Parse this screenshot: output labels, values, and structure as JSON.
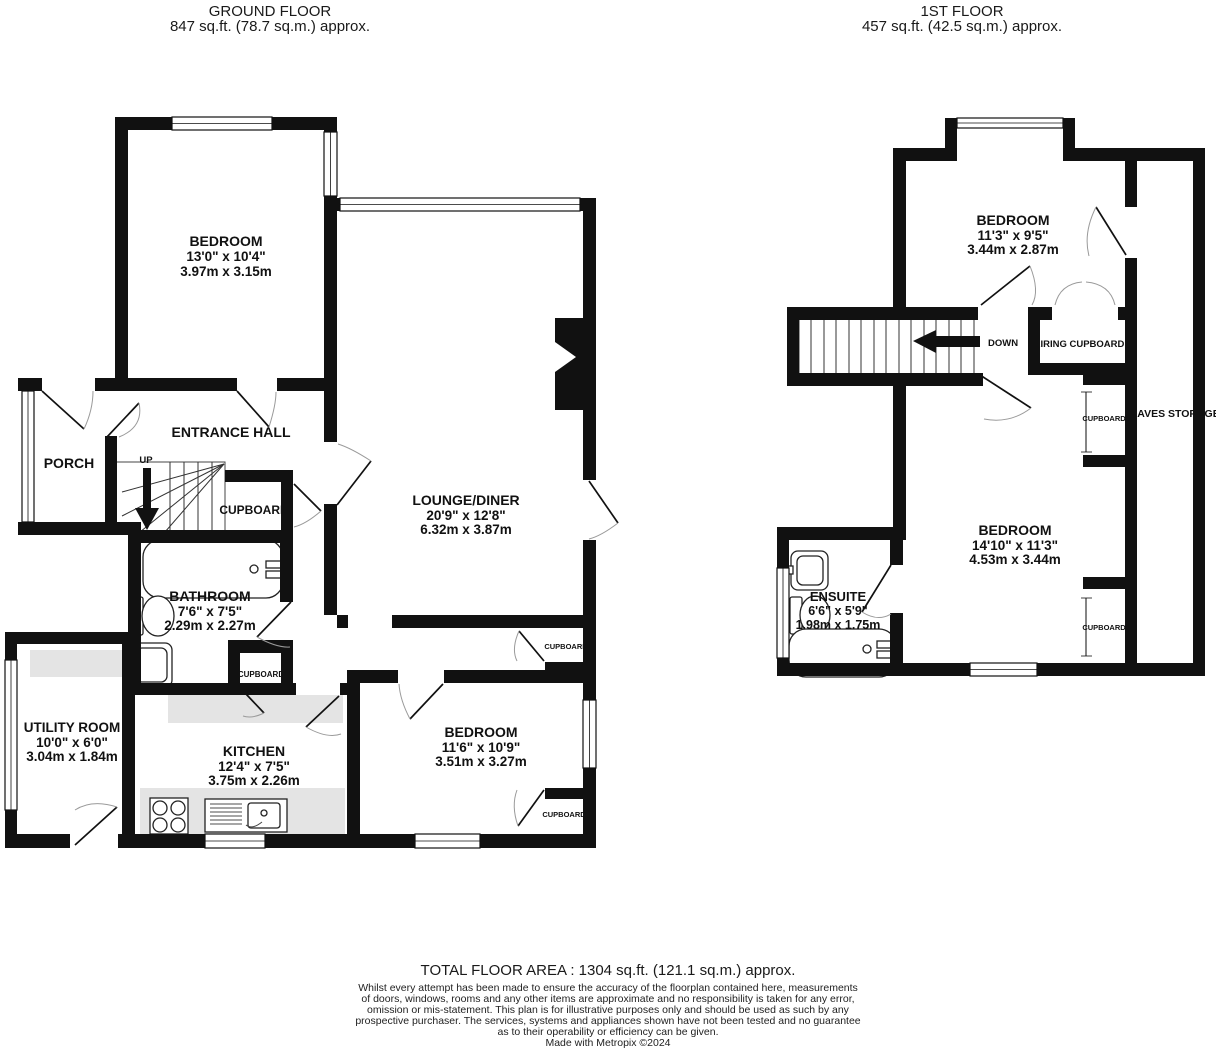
{
  "colors": {
    "wall": "#111111",
    "counter": "#e4e4e4",
    "door_arc": "#9a9a9a"
  },
  "ground_floor": {
    "title": "GROUND FLOOR",
    "area": "847 sq.ft. (78.7 sq.m.) approx.",
    "bedroom1": {
      "name": "BEDROOM",
      "imperial": "13'0\"  x 10'4\"",
      "metric": "3.97m  x 3.15m"
    },
    "entrance_hall": {
      "name": "ENTRANCE HALL"
    },
    "porch": {
      "name": "PORCH"
    },
    "up_label": "UP",
    "cupboard_understairs": "CUPBOARD",
    "lounge": {
      "name": "LOUNGE/DINER",
      "imperial": "20'9\"  x 12'8\"",
      "metric": "6.32m  x 3.87m"
    },
    "bathroom": {
      "name": "BATHROOM",
      "imperial": "7'6\"  x 7'5\"",
      "metric": "2.29m  x 2.27m"
    },
    "cupboard_bathroom": "CUPBOARD",
    "utility": {
      "name": "UTILITY ROOM",
      "imperial": "10'0\"  x 6'0\"",
      "metric": "3.04m  x 1.84m"
    },
    "kitchen": {
      "name": "KITCHEN",
      "imperial": "12'4\"  x 7'5\"",
      "metric": "3.75m  x 2.26m"
    },
    "bedroom2": {
      "name": "BEDROOM",
      "imperial": "11'6\"  x 10'9\"",
      "metric": "3.51m  x 3.27m"
    },
    "cupboard_hall": "CUPBOARD",
    "cupboard_bedroom": "CUPBOARD"
  },
  "first_floor": {
    "title": "1ST FLOOR",
    "area": "457 sq.ft. (42.5 sq.m.) approx.",
    "bedroom3": {
      "name": "BEDROOM",
      "imperial": "11'3\"  x 9'5\"",
      "metric": "3.44m  x 2.87m"
    },
    "down_label": "DOWN",
    "airing_cupboard": "AIRING CUPBOARD",
    "eaves_storage": "EAVES STORAGE",
    "cupboard_top": "CUPBOARD",
    "cupboard_bottom": "CUPBOARD",
    "bedroom4": {
      "name": "BEDROOM",
      "imperial": "14'10\"  x 11'3\"",
      "metric": "4.53m  x 3.44m"
    },
    "ensuite": {
      "name": "ENSUITE",
      "imperial": "6'6\"  x 5'9\"",
      "metric": "1.98m  x 1.75m"
    }
  },
  "footer": {
    "total": "TOTAL FLOOR AREA : 1304 sq.ft. (121.1 sq.m.) approx.",
    "disclaimer_lines": [
      "Whilst every attempt has been made to ensure the accuracy of the floorplan contained here, measurements",
      "of doors, windows, rooms and any other items are approximate and no responsibility is taken for any error,",
      "omission or mis-statement. This plan is for illustrative purposes only and should be used as such by any",
      "prospective purchaser. The services, systems and appliances shown have not been tested and no guarantee",
      "as to their operability or efficiency can be given."
    ],
    "credit": "Made with Metropix ©2024"
  }
}
